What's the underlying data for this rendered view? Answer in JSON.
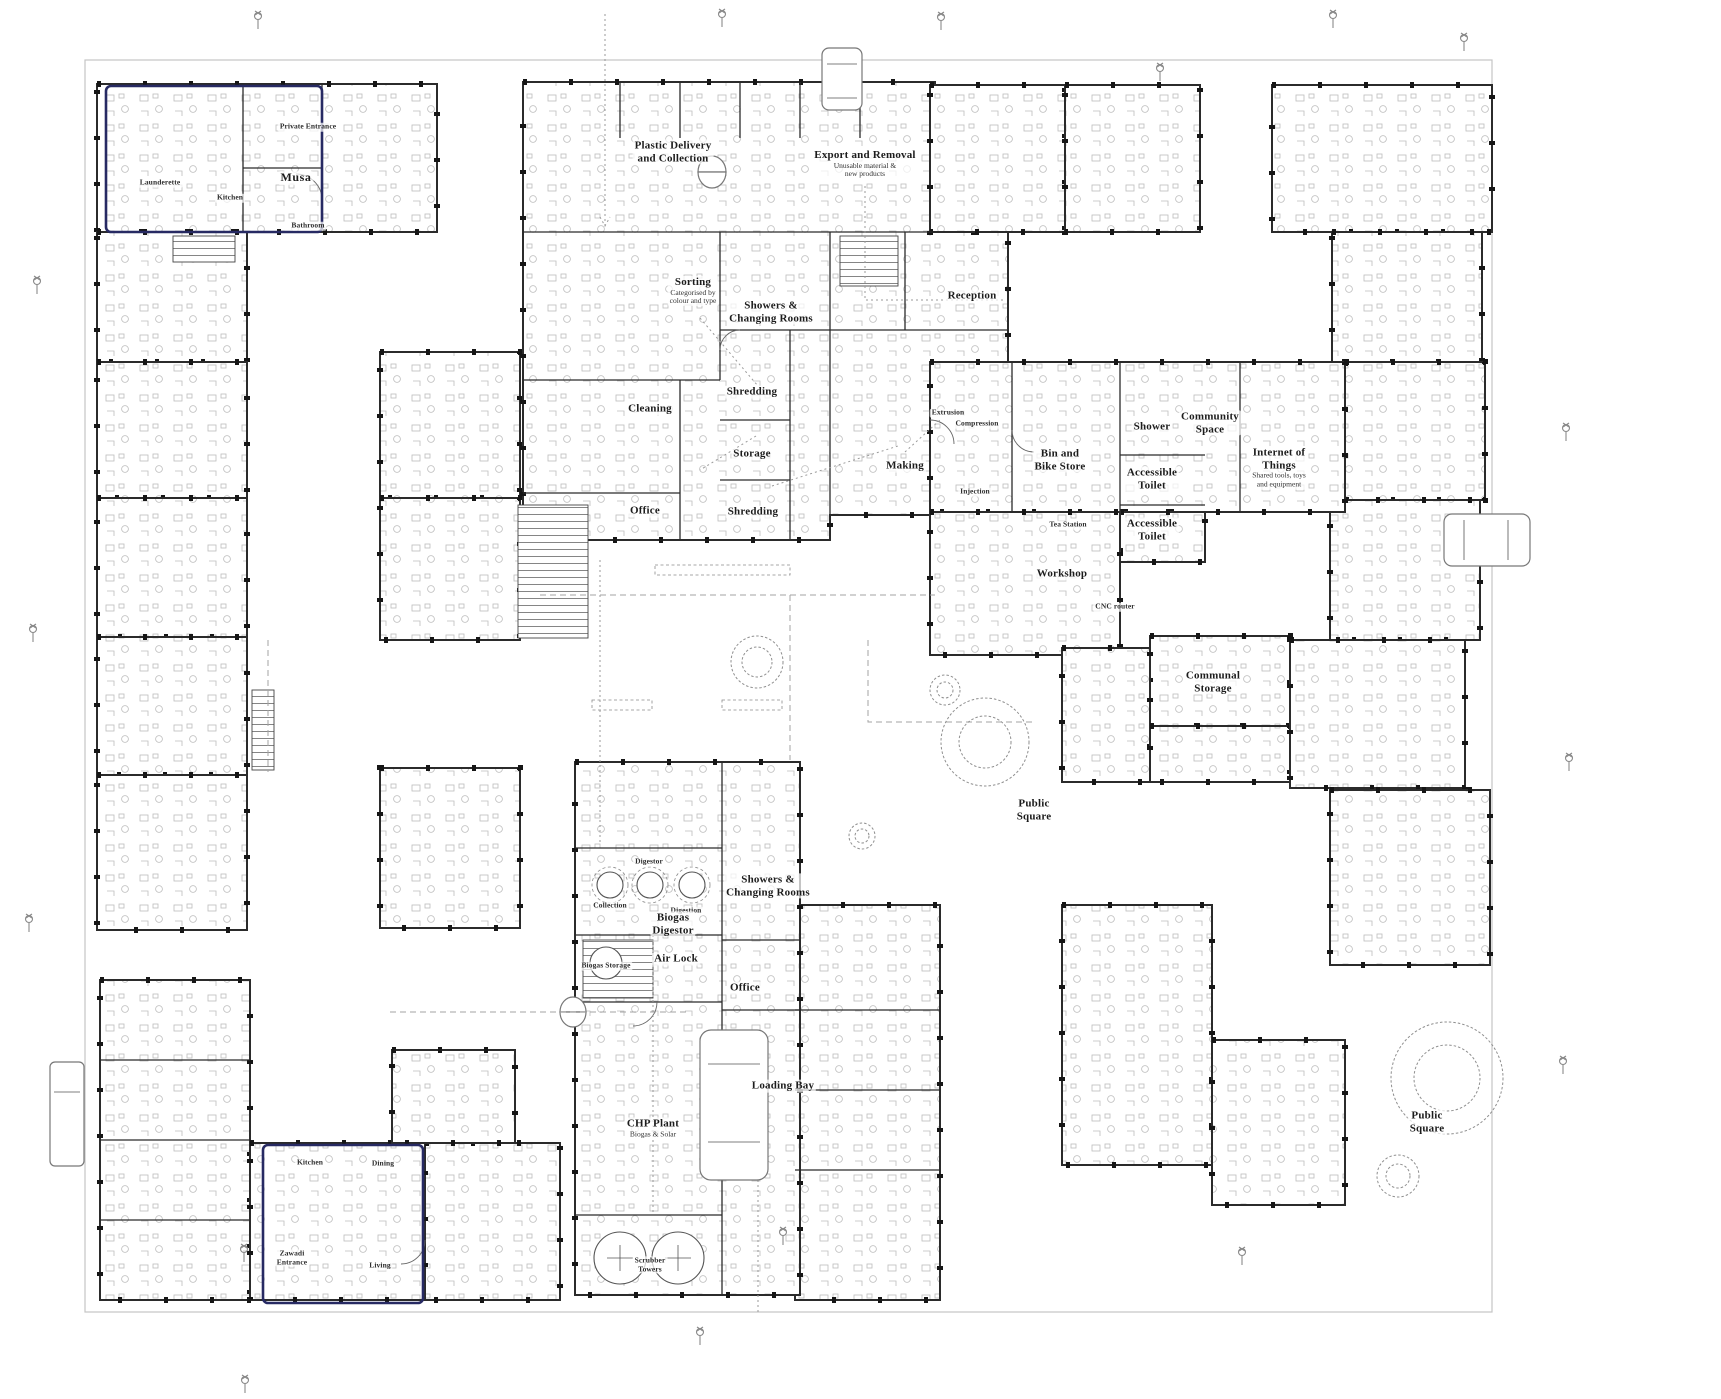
{
  "colors": {
    "wall": "#2b2b2b",
    "highlight": "#272a63",
    "paper": "#ffffff",
    "light_line": "#9a9a9a"
  },
  "highlighted_units": [
    {
      "unit": "Musa"
    },
    {
      "unit": "Zawadi"
    }
  ],
  "icons": [
    "tree-icon",
    "street-lamp-icon",
    "van-icon",
    "car-icon",
    "truck-icon",
    "delivery-van-icon",
    "double-door-icon",
    "stair-icon",
    "digester-tank-icon",
    "scrubber-tower-icon"
  ],
  "labels": [
    {
      "x": 673,
      "y": 152,
      "size": "md",
      "lines": [
        "Plastic Delivery",
        "and Collection"
      ]
    },
    {
      "x": 865,
      "y": 164,
      "size": "md",
      "lines": [
        "Export and Removal"
      ],
      "sub": [
        "Unusable material &",
        "new products"
      ]
    },
    {
      "x": 693,
      "y": 291,
      "size": "md",
      "lines": [
        "Sorting"
      ],
      "sub": [
        "Categorised by",
        "colour and type"
      ]
    },
    {
      "x": 771,
      "y": 312,
      "size": "md",
      "lines": [
        "Showers &",
        "Changing Rooms"
      ]
    },
    {
      "x": 972,
      "y": 296,
      "size": "md",
      "lines": [
        "Reception"
      ]
    },
    {
      "x": 650,
      "y": 409,
      "size": "md",
      "lines": [
        "Cleaning"
      ]
    },
    {
      "x": 752,
      "y": 392,
      "size": "md",
      "lines": [
        "Shredding"
      ]
    },
    {
      "x": 752,
      "y": 454,
      "size": "md",
      "lines": [
        "Storage"
      ]
    },
    {
      "x": 753,
      "y": 512,
      "size": "md",
      "lines": [
        "Shredding"
      ]
    },
    {
      "x": 645,
      "y": 511,
      "size": "md",
      "lines": [
        "Office"
      ]
    },
    {
      "x": 905,
      "y": 466,
      "size": "md",
      "lines": [
        "Making"
      ]
    },
    {
      "x": 948,
      "y": 413,
      "size": "xs",
      "lines": [
        "Extrusion"
      ]
    },
    {
      "x": 977,
      "y": 424,
      "size": "xs",
      "lines": [
        "Compression"
      ]
    },
    {
      "x": 975,
      "y": 492,
      "size": "xs",
      "lines": [
        "Injection"
      ]
    },
    {
      "x": 1060,
      "y": 460,
      "size": "md",
      "lines": [
        "Bin and",
        "Bike Store"
      ]
    },
    {
      "x": 1152,
      "y": 427,
      "size": "md",
      "lines": [
        "Shower"
      ]
    },
    {
      "x": 1152,
      "y": 479,
      "size": "md",
      "lines": [
        "Accessible",
        "Toilet"
      ]
    },
    {
      "x": 1152,
      "y": 530,
      "size": "md",
      "lines": [
        "Accessible",
        "Toilet"
      ]
    },
    {
      "x": 1210,
      "y": 423,
      "size": "md",
      "lines": [
        "Community",
        "Space"
      ]
    },
    {
      "x": 1279,
      "y": 468,
      "size": "md",
      "lines": [
        "Internet of",
        "Things"
      ],
      "sub": [
        "Shared tools, toys",
        "and equipment"
      ]
    },
    {
      "x": 1068,
      "y": 525,
      "size": "xs",
      "lines": [
        "Tea Station"
      ]
    },
    {
      "x": 1062,
      "y": 574,
      "size": "md",
      "lines": [
        "Workshop"
      ]
    },
    {
      "x": 1115,
      "y": 607,
      "size": "xs",
      "lines": [
        "CNC router"
      ]
    },
    {
      "x": 1213,
      "y": 682,
      "size": "md",
      "lines": [
        "Communal",
        "Storage"
      ]
    },
    {
      "x": 649,
      "y": 862,
      "size": "xs",
      "lines": [
        "Digestor"
      ]
    },
    {
      "x": 610,
      "y": 906,
      "size": "xs",
      "lines": [
        "Collection"
      ]
    },
    {
      "x": 686,
      "y": 911,
      "size": "xs",
      "lines": [
        "Digestion"
      ]
    },
    {
      "x": 673,
      "y": 924,
      "size": "md",
      "lines": [
        "Biogas",
        "Digestor"
      ]
    },
    {
      "x": 676,
      "y": 959,
      "size": "md",
      "lines": [
        "Air Lock"
      ]
    },
    {
      "x": 606,
      "y": 966,
      "size": "xs",
      "lines": [
        "Biogas Storage"
      ]
    },
    {
      "x": 745,
      "y": 988,
      "size": "md",
      "lines": [
        "Office"
      ]
    },
    {
      "x": 768,
      "y": 886,
      "size": "md",
      "lines": [
        "Showers &",
        "Changing Rooms"
      ]
    },
    {
      "x": 653,
      "y": 1128,
      "size": "md",
      "lines": [
        "CHP Plant"
      ],
      "sub": [
        "Biogas & Solar"
      ]
    },
    {
      "x": 783,
      "y": 1086,
      "size": "md",
      "lines": [
        "Loading Bay"
      ]
    },
    {
      "x": 650,
      "y": 1265,
      "size": "xs",
      "lines": [
        "Scrubber",
        "Towers"
      ]
    },
    {
      "x": 1034,
      "y": 810,
      "size": "md",
      "lines": [
        "Public",
        "Square"
      ]
    },
    {
      "x": 1427,
      "y": 1122,
      "size": "md",
      "lines": [
        "Public",
        "Square"
      ]
    },
    {
      "x": 296,
      "y": 178,
      "size": "name",
      "lines": [
        "Musa"
      ]
    },
    {
      "x": 308,
      "y": 127,
      "size": "xs",
      "lines": [
        "Private Entrance"
      ]
    },
    {
      "x": 160,
      "y": 183,
      "size": "xs",
      "lines": [
        "Launderette"
      ]
    },
    {
      "x": 230,
      "y": 198,
      "size": "xs",
      "lines": [
        "Kitchen"
      ]
    },
    {
      "x": 308,
      "y": 226,
      "size": "xs",
      "lines": [
        "Bathroom"
      ]
    },
    {
      "x": 310,
      "y": 1163,
      "size": "xs",
      "lines": [
        "Kitchen"
      ]
    },
    {
      "x": 383,
      "y": 1164,
      "size": "xs",
      "lines": [
        "Dining"
      ]
    },
    {
      "x": 380,
      "y": 1266,
      "size": "xs",
      "lines": [
        "Living"
      ]
    },
    {
      "x": 292,
      "y": 1258,
      "size": "xs",
      "lines": [
        "Zawadi",
        "Entrance"
      ]
    }
  ]
}
